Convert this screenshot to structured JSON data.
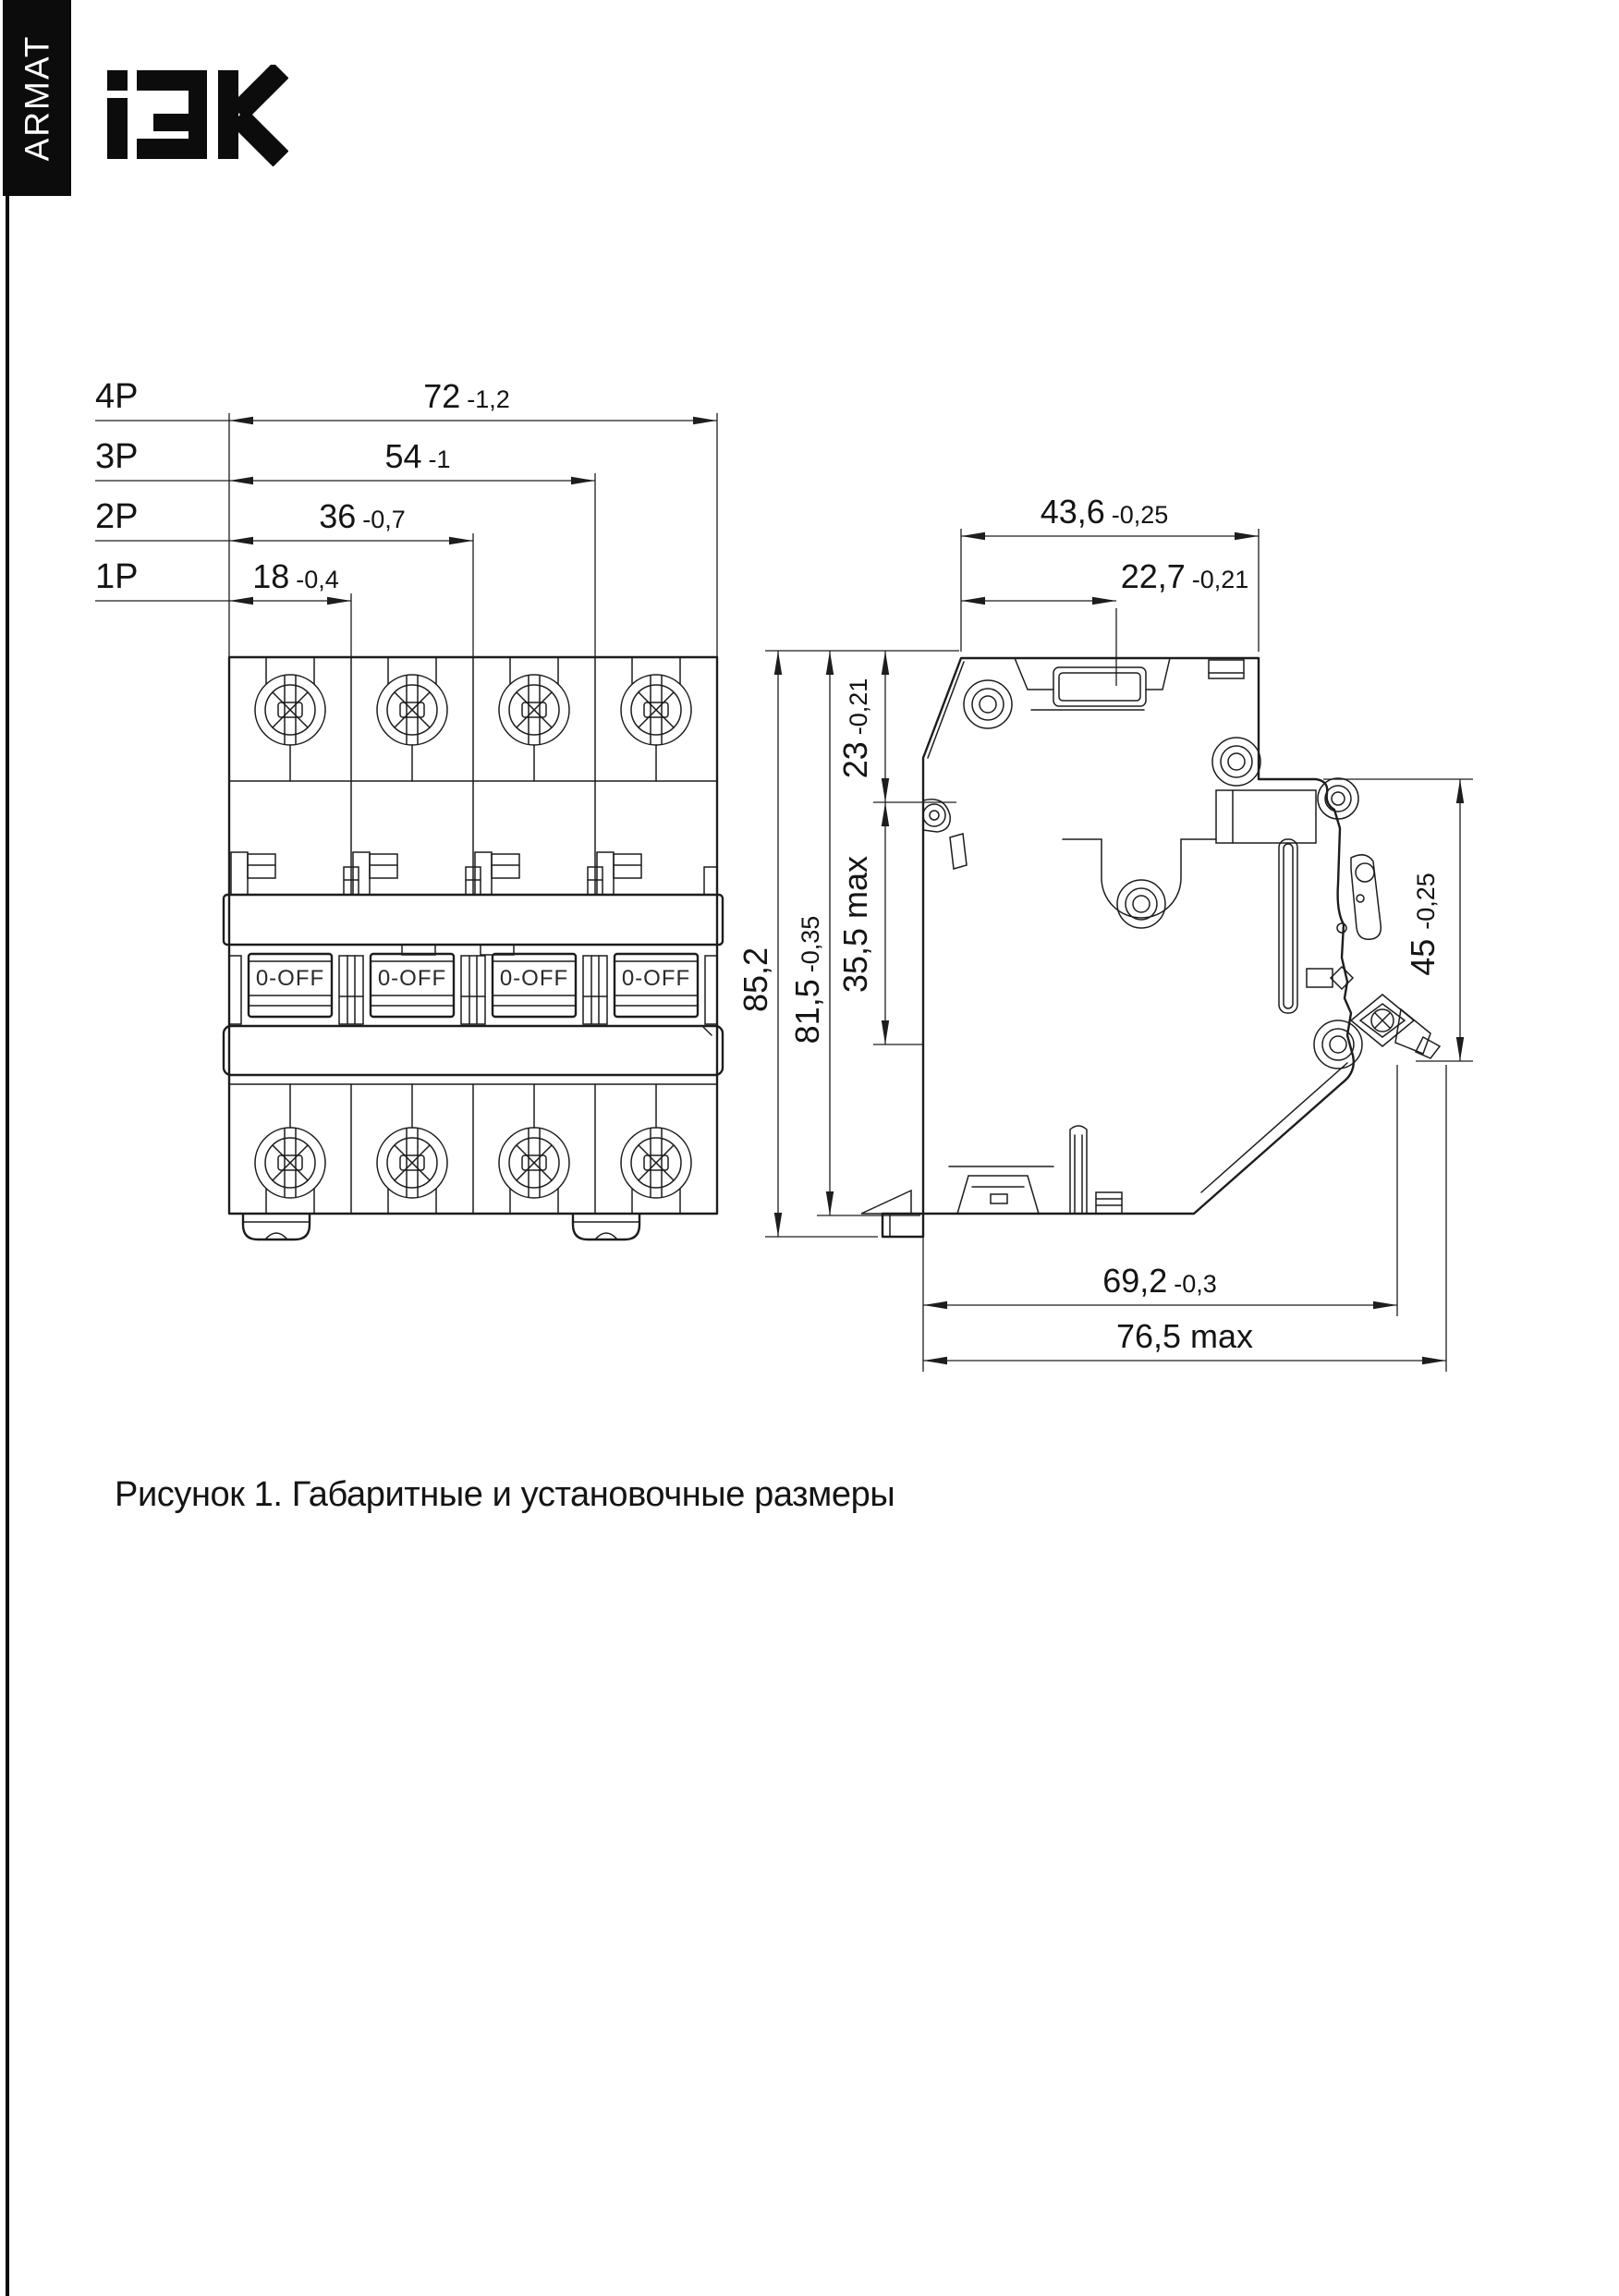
{
  "brand": {
    "sidebar_text": "ARMAT",
    "logo_text": "IEK"
  },
  "caption": "Рисунок 1. Габаритные и установочные размеры",
  "front_view": {
    "switch_state_label": "0-OFF",
    "pole_dims": [
      {
        "label": "4P",
        "value": "72",
        "tolerance": "-1,2"
      },
      {
        "label": "3P",
        "value": "54",
        "tolerance": "-1"
      },
      {
        "label": "2P",
        "value": "36",
        "tolerance": "-0,7"
      },
      {
        "label": "1P",
        "value": "18",
        "tolerance": "-0,4"
      }
    ]
  },
  "side_view": {
    "dims": {
      "width_top": {
        "value": "43,6",
        "tolerance": "-0,25"
      },
      "handle_offset": {
        "value": "22,7",
        "tolerance": "-0,21"
      },
      "top_to_pad": {
        "value": "23",
        "tolerance": "-0,21"
      },
      "pad_zone": {
        "value": "35,5 max",
        "tolerance": ""
      },
      "body_height": {
        "value": "81,5",
        "tolerance": "-0,35"
      },
      "overall_height": {
        "value": "85,2",
        "tolerance": ""
      },
      "din_recess": {
        "value": "45",
        "tolerance": "-0,25"
      },
      "body_depth": {
        "value": "69,2",
        "tolerance": "-0,3"
      },
      "max_depth": {
        "value": "76,5 max",
        "tolerance": ""
      }
    }
  }
}
